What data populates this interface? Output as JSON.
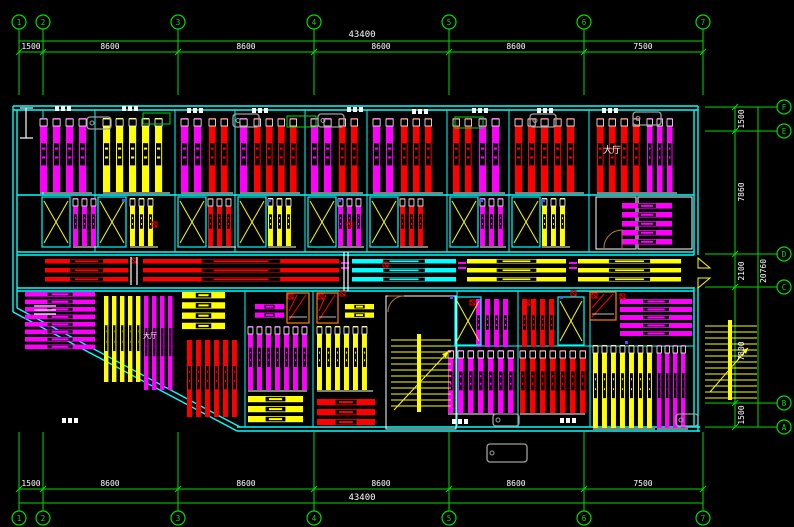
{
  "meta": {
    "app_title": "CAD floor plan drawing",
    "canvas_w": 794,
    "canvas_h": 527,
    "bg": "#000000"
  },
  "palette": {
    "G": "#00dd00",
    "C": "#00ffff",
    "M": "#ff00ff",
    "R": "#ff0000",
    "Y": "#ffff00",
    "W": "#ffffff",
    "GY": "#a0a0a0",
    "O": "#ff8000",
    "BR": "#b97a45",
    "B": "#4455ff"
  },
  "axes": {
    "top": {
      "labels": [
        "1",
        "2",
        "3",
        "4",
        "5",
        "6",
        "7"
      ],
      "xs": [
        19,
        43,
        178,
        314,
        449,
        584,
        703
      ],
      "bubble_y": 22,
      "line_y1": 41,
      "line_y2": 52
    },
    "bottom": {
      "labels": [
        "1",
        "2",
        "3",
        "4",
        "5",
        "6",
        "7"
      ],
      "xs": [
        19,
        43,
        178,
        314,
        449,
        584,
        703
      ],
      "bubble_y": 518,
      "line_y1": 489,
      "line_y2": 503
    },
    "right": {
      "labels": [
        "F",
        "E",
        "D",
        "C",
        "B",
        "A"
      ],
      "ys": [
        107,
        131,
        254,
        287,
        403,
        427
      ],
      "bubble_x": 784,
      "line_x1": 735,
      "line_x2": 758
    }
  },
  "texts": [
    {
      "t": "43400",
      "x": 362,
      "y": 37,
      "s": 9
    },
    {
      "t": "1500",
      "x": 31,
      "y": 49,
      "s": 8
    },
    {
      "t": "8600",
      "x": 110,
      "y": 49,
      "s": 8
    },
    {
      "t": "8600",
      "x": 246,
      "y": 49,
      "s": 8
    },
    {
      "t": "8600",
      "x": 381,
      "y": 49,
      "s": 8
    },
    {
      "t": "8600",
      "x": 516,
      "y": 49,
      "s": 8
    },
    {
      "t": "7500",
      "x": 643,
      "y": 49,
      "s": 8
    },
    {
      "t": "1500",
      "x": 31,
      "y": 486,
      "s": 8
    },
    {
      "t": "8600",
      "x": 110,
      "y": 486,
      "s": 8
    },
    {
      "t": "8600",
      "x": 246,
      "y": 486,
      "s": 8
    },
    {
      "t": "8600",
      "x": 381,
      "y": 486,
      "s": 8
    },
    {
      "t": "8600",
      "x": 516,
      "y": 486,
      "s": 8
    },
    {
      "t": "7500",
      "x": 643,
      "y": 486,
      "s": 8
    },
    {
      "t": "43400",
      "x": 362,
      "y": 500,
      "s": 9
    },
    {
      "t": "1500",
      "x": 744,
      "y": 119,
      "s": 8,
      "rot": -90
    },
    {
      "t": "7860",
      "x": 744,
      "y": 192,
      "s": 8,
      "rot": -90
    },
    {
      "t": "2100",
      "x": 744,
      "y": 271,
      "s": 8,
      "rot": -90
    },
    {
      "t": "7800",
      "x": 744,
      "y": 351,
      "s": 8,
      "rot": -90
    },
    {
      "t": "1500",
      "x": 744,
      "y": 415,
      "s": 8,
      "rot": -90
    },
    {
      "t": "20760",
      "x": 766,
      "y": 271,
      "s": 8,
      "rot": -90
    },
    {
      "t": "大厅",
      "x": 612,
      "y": 153,
      "s": 9
    },
    {
      "t": "大厅",
      "x": 150,
      "y": 338,
      "s": 7
    }
  ],
  "drawing": {
    "walls": [
      [
        13,
        106,
        698,
        106
      ],
      [
        13,
        110,
        698,
        110
      ],
      [
        13,
        106,
        13,
        312
      ],
      [
        17,
        110,
        17,
        308
      ],
      [
        13,
        312,
        237,
        431
      ],
      [
        17,
        308,
        240,
        427
      ],
      [
        237,
        427,
        700,
        427
      ],
      [
        237,
        431,
        700,
        431
      ],
      [
        698,
        106,
        698,
        255
      ],
      [
        694,
        110,
        694,
        255
      ],
      [
        698,
        287,
        698,
        431
      ],
      [
        694,
        287,
        694,
        427
      ],
      [
        17,
        252,
        694,
        252
      ],
      [
        17,
        255,
        694,
        255
      ],
      [
        17,
        288,
        694,
        288
      ],
      [
        17,
        291,
        694,
        291
      ],
      [
        17,
        195,
        694,
        195
      ]
    ],
    "partitions": [
      [
        95,
        110,
        95,
        252
      ],
      [
        175,
        110,
        175,
        252
      ],
      [
        235,
        110,
        235,
        252
      ],
      [
        305,
        110,
        305,
        252
      ],
      [
        367,
        110,
        367,
        252
      ],
      [
        447,
        110,
        447,
        252
      ],
      [
        509,
        110,
        509,
        252
      ],
      [
        589,
        110,
        589,
        252
      ],
      [
        43,
        110,
        43,
        195
      ],
      [
        245,
        291,
        245,
        427
      ],
      [
        313,
        291,
        313,
        427
      ],
      [
        457,
        291,
        457,
        427
      ],
      [
        518,
        291,
        518,
        427
      ],
      [
        590,
        291,
        590,
        427
      ],
      [
        448,
        346,
        694,
        346
      ]
    ],
    "vstripes": [
      {
        "x": 40,
        "y": 118,
        "w": 52,
        "h": 74,
        "c": "M",
        "p": 13,
        "caps": 1
      },
      {
        "x": 103,
        "y": 118,
        "w": 67,
        "h": 74,
        "c": "Y",
        "p": 13,
        "caps": 1
      },
      {
        "x": 181,
        "y": 118,
        "w": 28,
        "h": 74,
        "c": "M",
        "p": 13,
        "caps": 1
      },
      {
        "x": 209,
        "y": 118,
        "w": 24,
        "h": 74,
        "c": "R",
        "p": 12,
        "caps": 1
      },
      {
        "x": 240,
        "y": 118,
        "w": 14,
        "h": 74,
        "c": "M",
        "p": 13,
        "caps": 1
      },
      {
        "x": 254,
        "y": 118,
        "w": 46,
        "h": 74,
        "c": "R",
        "p": 12,
        "caps": 1
      },
      {
        "x": 311,
        "y": 118,
        "w": 28,
        "h": 74,
        "c": "M",
        "p": 13,
        "caps": 1
      },
      {
        "x": 339,
        "y": 118,
        "w": 24,
        "h": 74,
        "c": "R",
        "p": 12,
        "caps": 1
      },
      {
        "x": 373,
        "y": 118,
        "w": 28,
        "h": 74,
        "c": "M",
        "p": 13,
        "caps": 1
      },
      {
        "x": 401,
        "y": 118,
        "w": 42,
        "h": 74,
        "c": "R",
        "p": 12,
        "caps": 1
      },
      {
        "x": 453,
        "y": 118,
        "w": 26,
        "h": 74,
        "c": "R",
        "p": 12,
        "caps": 1
      },
      {
        "x": 479,
        "y": 118,
        "w": 26,
        "h": 74,
        "c": "M",
        "p": 13,
        "caps": 1
      },
      {
        "x": 515,
        "y": 118,
        "w": 69,
        "h": 74,
        "c": "R",
        "p": 13,
        "caps": 1
      },
      {
        "x": 597,
        "y": 118,
        "w": 50,
        "h": 74,
        "c": "R",
        "p": 12,
        "caps": 1
      },
      {
        "x": 647,
        "y": 118,
        "w": 30,
        "h": 74,
        "c": "M",
        "p": 10,
        "caps": 1
      },
      {
        "x": 73,
        "y": 198,
        "w": 30,
        "h": 48,
        "c": "M",
        "p": 9,
        "caps": 1
      },
      {
        "x": 130,
        "y": 198,
        "w": 28,
        "h": 48,
        "c": "Y",
        "p": 9,
        "caps": 1
      },
      {
        "x": 208,
        "y": 198,
        "w": 28,
        "h": 48,
        "c": "R",
        "p": 9,
        "caps": 1
      },
      {
        "x": 268,
        "y": 198,
        "w": 28,
        "h": 48,
        "c": "Y",
        "p": 9,
        "caps": 1
      },
      {
        "x": 338,
        "y": 198,
        "w": 26,
        "h": 48,
        "c": "M",
        "p": 9,
        "caps": 1
      },
      {
        "x": 400,
        "y": 198,
        "w": 28,
        "h": 48,
        "c": "R",
        "p": 9,
        "caps": 1
      },
      {
        "x": 480,
        "y": 198,
        "w": 26,
        "h": 48,
        "c": "M",
        "p": 9,
        "caps": 1
      },
      {
        "x": 542,
        "y": 198,
        "w": 28,
        "h": 48,
        "c": "Y",
        "p": 9,
        "caps": 1
      },
      {
        "x": 104,
        "y": 296,
        "w": 39,
        "h": 86,
        "c": "Y",
        "p": 8,
        "caps": 0
      },
      {
        "x": 144,
        "y": 296,
        "w": 32,
        "h": 94,
        "c": "M",
        "p": 8,
        "caps": 0
      },
      {
        "x": 187,
        "y": 340,
        "w": 53,
        "h": 77,
        "c": "R",
        "p": 9,
        "caps": 0
      },
      {
        "x": 248,
        "y": 326,
        "w": 59,
        "h": 64,
        "c": "M",
        "p": 9,
        "caps": 1
      },
      {
        "x": 317,
        "y": 326,
        "w": 56,
        "h": 64,
        "c": "Y",
        "p": 9,
        "caps": 1
      },
      {
        "x": 476,
        "y": 299,
        "w": 40,
        "h": 48,
        "c": "M",
        "p": 9,
        "caps": 0
      },
      {
        "x": 522,
        "y": 299,
        "w": 40,
        "h": 48,
        "c": "R",
        "p": 9,
        "caps": 0
      },
      {
        "x": 448,
        "y": 350,
        "w": 67,
        "h": 63,
        "c": "M",
        "p": 10,
        "caps": 1
      },
      {
        "x": 520,
        "y": 350,
        "w": 65,
        "h": 63,
        "c": "R",
        "p": 10,
        "caps": 1
      },
      {
        "x": 593,
        "y": 345,
        "w": 62,
        "h": 83,
        "c": "Y",
        "p": 9,
        "caps": 1
      },
      {
        "x": 657,
        "y": 345,
        "w": 31,
        "h": 83,
        "c": "M",
        "p": 8,
        "caps": 1
      }
    ],
    "hbars": [
      {
        "x": 25,
        "y": 292,
        "w": 70,
        "h": 60,
        "n": 8,
        "c": "M"
      },
      {
        "x": 182,
        "y": 292,
        "w": 43,
        "h": 41,
        "n": 4,
        "c": "Y"
      },
      {
        "x": 248,
        "y": 396,
        "w": 55,
        "h": 30,
        "n": 3,
        "c": "Y"
      },
      {
        "x": 317,
        "y": 399,
        "w": 58,
        "h": 30,
        "n": 3,
        "c": "R"
      },
      {
        "x": 622,
        "y": 203,
        "w": 50,
        "h": 45,
        "n": 5,
        "c": "M"
      },
      {
        "x": 620,
        "y": 299,
        "w": 72,
        "h": 40,
        "n": 5,
        "c": "M"
      },
      {
        "x": 255,
        "y": 304,
        "w": 29,
        "h": 17,
        "n": 2,
        "c": "M"
      },
      {
        "x": 345,
        "y": 304,
        "w": 29,
        "h": 17,
        "n": 2,
        "c": "Y"
      }
    ],
    "corridor": {
      "bar_ys": [
        259,
        268,
        277
      ],
      "bar_h": 4.5,
      "segs": [
        {
          "x": 45,
          "w": 83,
          "c": "R"
        },
        {
          "x": 143,
          "w": 196,
          "c": "R"
        },
        {
          "x": 352,
          "w": 104,
          "c": "C"
        },
        {
          "x": 467,
          "w": 99,
          "c": "Y"
        },
        {
          "x": 578,
          "w": 103,
          "c": "Y"
        }
      ],
      "code_dashes": [
        [
          341,
          262
        ],
        [
          458,
          262
        ],
        [
          569,
          262
        ]
      ]
    },
    "pods": [
      {
        "x": 42,
        "y": 197,
        "w": 28,
        "h": 50
      },
      {
        "x": 98,
        "y": 197,
        "w": 28,
        "h": 50
      },
      {
        "x": 178,
        "y": 197,
        "w": 28,
        "h": 50
      },
      {
        "x": 238,
        "y": 197,
        "w": 28,
        "h": 50
      },
      {
        "x": 308,
        "y": 197,
        "w": 28,
        "h": 50
      },
      {
        "x": 370,
        "y": 197,
        "w": 28,
        "h": 50
      },
      {
        "x": 450,
        "y": 197,
        "w": 28,
        "h": 50
      },
      {
        "x": 512,
        "y": 197,
        "w": 28,
        "h": 50
      },
      {
        "x": 455,
        "y": 297,
        "w": 26,
        "h": 48
      },
      {
        "x": 558,
        "y": 297,
        "w": 26,
        "h": 48
      }
    ],
    "orange_pods": [
      [
        287,
        293,
        22,
        30
      ],
      [
        317,
        293,
        21,
        30
      ],
      [
        590,
        292,
        26,
        28
      ]
    ],
    "white_rooms": [
      [
        596,
        197,
        40,
        52
      ],
      [
        638,
        197,
        54,
        52
      ],
      [
        386,
        296,
        70,
        133
      ]
    ],
    "stairs": [
      {
        "x": 391,
        "sy": 340,
        "ex": 451,
        "to": 410,
        "step": 6,
        "post": [
          417,
          334,
          4,
          78
        ],
        "arrow": [
          394,
          410,
          448,
          352
        ]
      },
      {
        "x": 705,
        "sy": 326,
        "ex": 757,
        "to": 400,
        "step": 6,
        "post": [
          728,
          320,
          4,
          80
        ],
        "arrow": [
          710,
          392,
          748,
          348
        ]
      }
    ],
    "tubs": [
      [
        87,
        117,
        24,
        12
      ],
      [
        233,
        114,
        26,
        13
      ],
      [
        318,
        114,
        26,
        13
      ],
      [
        530,
        114,
        26,
        13
      ],
      [
        633,
        112,
        28,
        13
      ],
      [
        493,
        414,
        26,
        12
      ],
      [
        676,
        414,
        22,
        12
      ],
      [
        487,
        444,
        40,
        18
      ]
    ],
    "green_boxes": [
      [
        143,
        113,
        27,
        11
      ],
      [
        287,
        116,
        29,
        11
      ],
      [
        455,
        117,
        28,
        11
      ]
    ],
    "micro": [
      [
        55,
        106
      ],
      [
        122,
        106
      ],
      [
        187,
        108
      ],
      [
        252,
        108
      ],
      [
        347,
        107
      ],
      [
        412,
        109
      ],
      [
        472,
        108
      ],
      [
        537,
        108
      ],
      [
        602,
        108
      ],
      [
        62,
        418
      ],
      [
        452,
        419
      ],
      [
        560,
        418
      ]
    ],
    "markers": [
      [
        131,
        258
      ],
      [
        340,
        291
      ],
      [
        383,
        262
      ],
      [
        571,
        291
      ],
      [
        470,
        300
      ],
      [
        525,
        300
      ],
      [
        288,
        294
      ],
      [
        318,
        294
      ],
      [
        592,
        293
      ],
      [
        620,
        294
      ],
      [
        152,
        222
      ],
      [
        347,
        222
      ]
    ],
    "blue_dots": [
      [
        122,
        199
      ],
      [
        268,
        199
      ],
      [
        338,
        199
      ],
      [
        480,
        199
      ],
      [
        542,
        199
      ],
      [
        625,
        341
      ],
      [
        450,
        296
      ],
      [
        560,
        296
      ]
    ],
    "misc_white": [
      [
        344,
        252,
        344,
        291
      ],
      [
        348,
        252,
        348,
        291
      ],
      [
        20,
        108,
        33,
        108
      ],
      [
        26,
        108,
        26,
        138
      ],
      [
        20,
        138,
        33,
        138
      ],
      [
        34,
        306,
        56,
        306
      ],
      [
        34,
        310,
        56,
        310
      ],
      [
        34,
        314,
        56,
        314
      ],
      [
        131,
        257,
        131,
        285
      ],
      [
        137,
        257,
        137,
        285
      ]
    ],
    "door_arcs": [
      "M388,312 A16,16 0 0 1 404,296 L388,296",
      "M604,248 A18,18 0 0 1 622,230 L622,248"
    ],
    "chevrons": [
      [
        698,
        258,
        710,
        268,
        698,
        268
      ],
      [
        698,
        288,
        710,
        278,
        698,
        278
      ]
    ]
  }
}
